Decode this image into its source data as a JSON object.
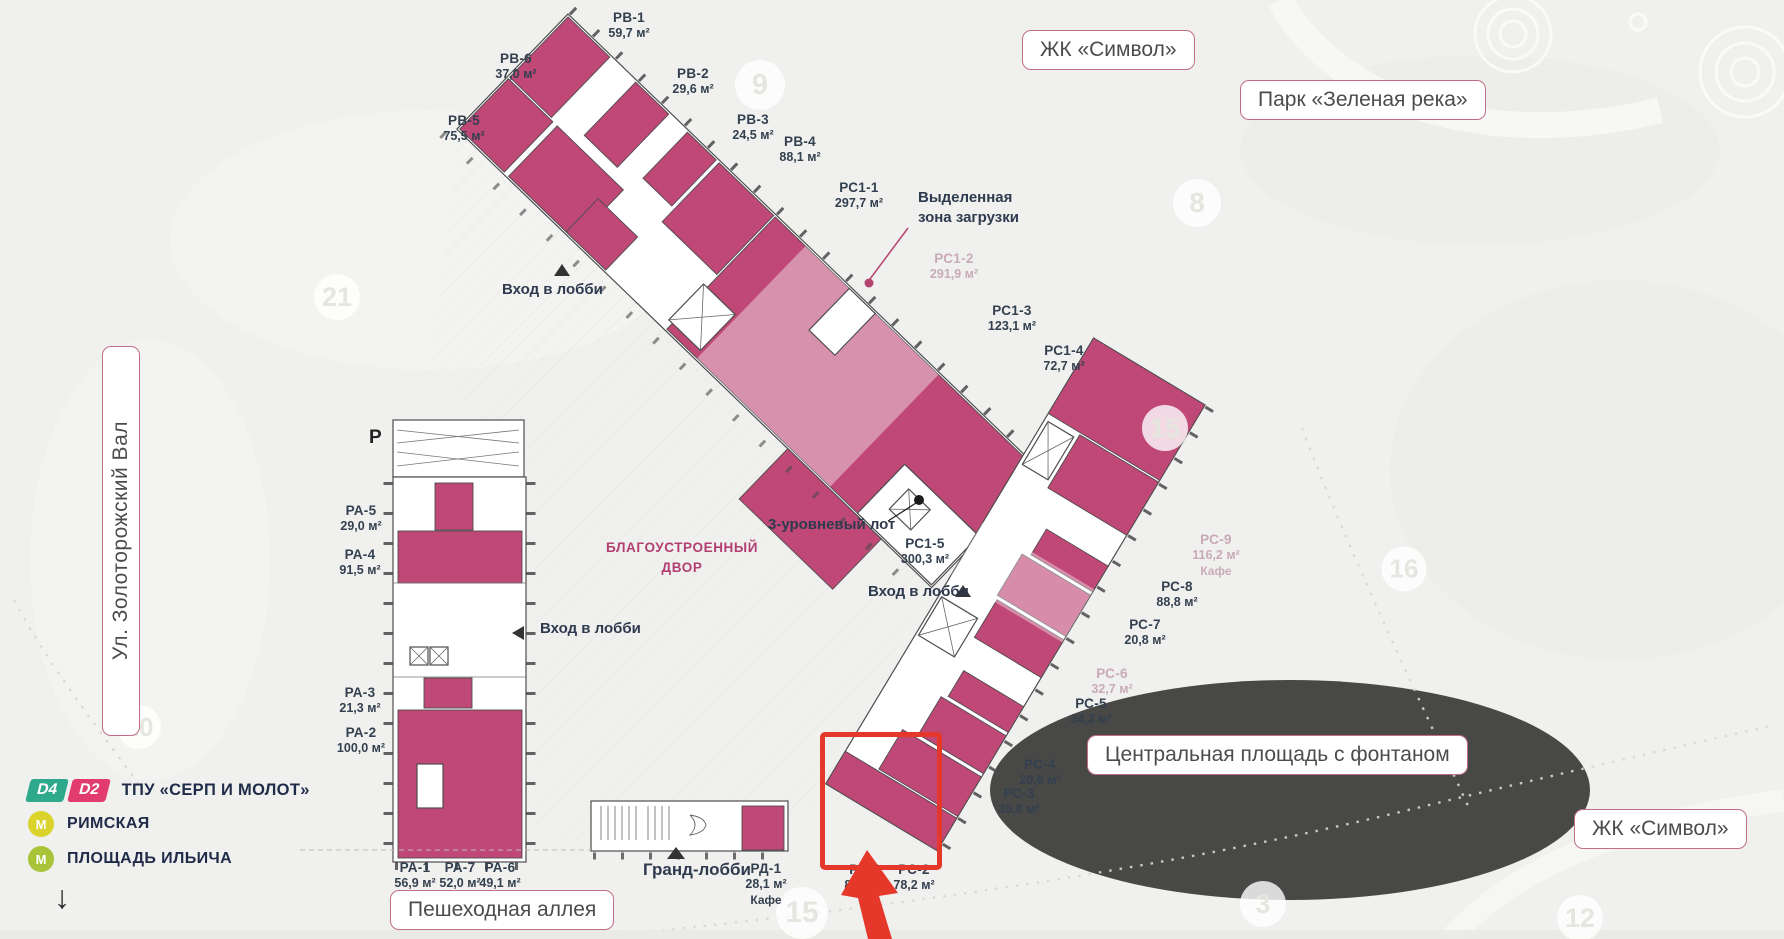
{
  "landmarks": {
    "zk_symbol_top": "ЖК «Символ»",
    "park": "Парк «Зеленая река»",
    "central_square": "Центральная площадь с фонтаном",
    "zk_symbol_bottom": "ЖК «Символ»",
    "pedestrian_alley": "Пешеходная аллея",
    "street": "Ул. Золоторожский Вал"
  },
  "legend": {
    "d4": "D4",
    "d2": "D2",
    "hub": "ТПУ «СЕРП И МОЛОТ»",
    "metro_mark": "М",
    "stations": [
      "РИМСКАЯ",
      "ПЛОЩАДЬ ИЛЬИЧА"
    ],
    "arrow": "↓"
  },
  "plan": {
    "parking_label": "Р",
    "courtyard_line1": "БЛАГОУСТРОЕННЫЙ",
    "courtyard_line2": "ДВОР",
    "loading_zone_line1": "Выделенная",
    "loading_zone_line2": "зона загрузки",
    "three_level_lot": "3-уровневый лот",
    "lobby_entrance": "Вход в лобби",
    "grand_lobby": "Гранд-лобби",
    "units": [
      {
        "id": "РВ-1",
        "area": "59,7 м²",
        "x": 629,
        "y": 10
      },
      {
        "id": "РВ-2",
        "area": "29,6 м²",
        "x": 693,
        "y": 66
      },
      {
        "id": "РВ-3",
        "area": "24,5 м²",
        "x": 753,
        "y": 112
      },
      {
        "id": "РВ-4",
        "area": "88,1 м²",
        "x": 800,
        "y": 134
      },
      {
        "id": "РВ-5",
        "area": "75,5 м²",
        "x": 464,
        "y": 113
      },
      {
        "id": "РВ-6",
        "area": "37,0 м²",
        "x": 516,
        "y": 51
      },
      {
        "id": "РС1-1",
        "area": "297,7 м²",
        "x": 859,
        "y": 180
      },
      {
        "id": "РС1-2",
        "area": "291,9 м²",
        "x": 954,
        "y": 251,
        "faded": true
      },
      {
        "id": "РС1-3",
        "area": "123,1 м²",
        "x": 1012,
        "y": 303
      },
      {
        "id": "РС1-4",
        "area": "72,7 м²",
        "x": 1064,
        "y": 343
      },
      {
        "id": "РС1-5",
        "area": "300,3 м²",
        "x": 925,
        "y": 536
      },
      {
        "id": "РС-1",
        "area": "81,1 м²",
        "x": 865,
        "y": 862
      },
      {
        "id": "РС-2",
        "area": "78,2 м²",
        "x": 914,
        "y": 862
      },
      {
        "id": "РС-3",
        "area": "35,8 м²",
        "x": 1019,
        "y": 786
      },
      {
        "id": "РС-4",
        "area": "20,6 м²",
        "x": 1040,
        "y": 757
      },
      {
        "id": "РС-5",
        "area": "34,3 м²",
        "x": 1091,
        "y": 696
      },
      {
        "id": "РС-6",
        "area": "32,7 м²",
        "x": 1112,
        "y": 666,
        "faded": true
      },
      {
        "id": "РС-7",
        "area": "20,8 м²",
        "x": 1145,
        "y": 617
      },
      {
        "id": "РС-8",
        "area": "88,8 м²",
        "x": 1177,
        "y": 579
      },
      {
        "id": "РС-9",
        "area": "116,2 м²",
        "note": "Кафе",
        "x": 1216,
        "y": 532,
        "faded": true
      },
      {
        "id": "РД-1",
        "area": "28,1 м²",
        "note": "Кафе",
        "x": 766,
        "y": 861
      },
      {
        "id": "РА-1",
        "area": "56,9 м²",
        "x": 415,
        "y": 860
      },
      {
        "id": "РА-2",
        "area": "100,0 м²",
        "x": 361,
        "y": 725
      },
      {
        "id": "РА-3",
        "area": "21,3 м²",
        "x": 360,
        "y": 685
      },
      {
        "id": "РА-4",
        "area": "91,5 м²",
        "x": 360,
        "y": 547
      },
      {
        "id": "РА-5",
        "area": "29,0 м²",
        "x": 361,
        "y": 503
      },
      {
        "id": "РА-6",
        "area": "49,1 м²",
        "x": 500,
        "y": 860
      },
      {
        "id": "РА-7",
        "area": "52,0 м²",
        "x": 460,
        "y": 860
      }
    ]
  },
  "map_numbers": [
    {
      "n": "9",
      "x": 760,
      "y": 85,
      "d": 50
    },
    {
      "n": "21",
      "x": 337,
      "y": 297,
      "d": 46
    },
    {
      "n": "8",
      "x": 1197,
      "y": 203,
      "d": 48
    },
    {
      "n": "15",
      "x": 1165,
      "y": 428,
      "d": 46
    },
    {
      "n": "16",
      "x": 1404,
      "y": 569,
      "d": 45
    },
    {
      "n": "20",
      "x": 139,
      "y": 727,
      "d": 44
    },
    {
      "n": "15",
      "x": 802,
      "y": 913,
      "d": 52
    },
    {
      "n": "3",
      "x": 1263,
      "y": 904,
      "d": 46
    },
    {
      "n": "12",
      "x": 1580,
      "y": 918,
      "d": 46
    }
  ],
  "colors": {
    "unit_fill": "#bf4877",
    "unit_fill_light": "#d999b6",
    "highlight_red": "#e5372a",
    "outline": "#4d4d4d",
    "ink": "#2e3a4d",
    "label_ink": "#33404f",
    "magenta_text": "#b23e72",
    "faded_label": "#c9abb8",
    "box_border": "#c06e86",
    "d4_green": "#2fa98c",
    "d2_pink": "#e23b6d",
    "metro_yellow": "#d9d32c",
    "metro_green": "#a9c438"
  }
}
